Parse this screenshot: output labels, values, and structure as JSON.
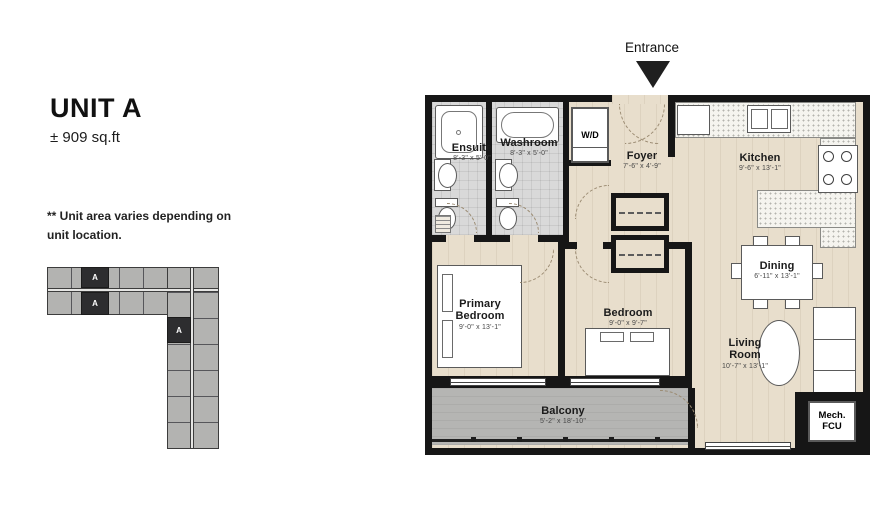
{
  "unit": {
    "title": "UNIT A",
    "area": "± 909 sq.ft"
  },
  "note": {
    "line1": "** Unit area varies depending on",
    "line2": "unit location."
  },
  "entrance": {
    "label": "Entrance"
  },
  "keyplan": {
    "marker": "A"
  },
  "rooms": {
    "ensuite": {
      "name": "Ensuite",
      "dims": "8'-3\" x 5'-0\""
    },
    "washroom": {
      "name": "Washroom",
      "dims": "8'-3\" x 5'-0\""
    },
    "wd": {
      "name": "W/D"
    },
    "foyer": {
      "name": "Foyer",
      "dims": "7'-6\" x 4'-9\""
    },
    "kitchen": {
      "name": "Kitchen",
      "dims": "9'-6\" x 13'-1\""
    },
    "dining": {
      "name": "Dining",
      "dims": "6'-11\" x 13'-1\""
    },
    "primary_bedroom": {
      "name": "Primary Bedroom",
      "dims": "9'-0\" x 13'-1\""
    },
    "bedroom": {
      "name": "Bedroom",
      "dims": "9'-0\" x 9'-7\""
    },
    "living_room": {
      "name": "Living Room",
      "dims": "10'-7\" x 13'-1\""
    },
    "balcony": {
      "name": "Balcony",
      "dims": "5'-2\" x 18'-10\""
    },
    "mech": {
      "name": "Mech. FCU"
    }
  },
  "colors": {
    "wall": "#161616",
    "wood": "#e8decc",
    "tile": "#d9d9d9",
    "balcony": "#b5b5b3",
    "counter": "#f5f4ef"
  }
}
